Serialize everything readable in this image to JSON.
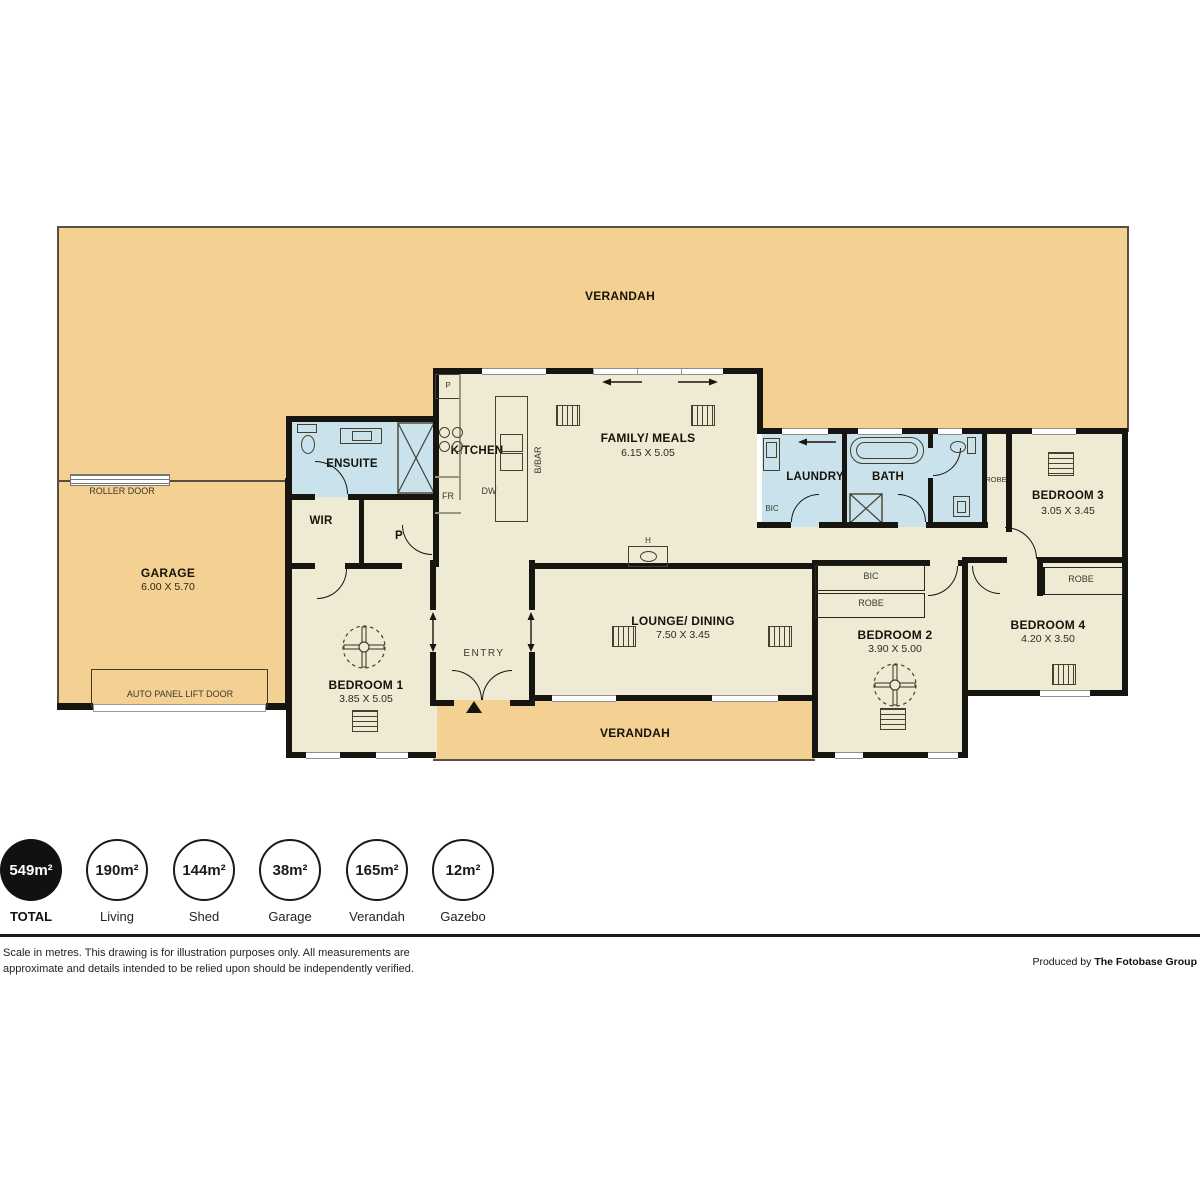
{
  "plan": {
    "verandah_top": "VERANDAH",
    "verandah_bottom": "VERANDAH",
    "garage": {
      "name": "GARAGE",
      "dims": "6.00 X 5.70"
    },
    "roller_door": "ROLLER DOOR",
    "auto_panel_lift_door": "AUTO PANEL LIFT DOOR",
    "ensuite": "ENSUITE",
    "wir": "WIR",
    "pantry": "P",
    "kitchen": {
      "name": "KITCHEN",
      "pantry": "P",
      "fridge": "FR",
      "dishwasher": "DW",
      "breakfast_bar": "B/BAR"
    },
    "family_meals": {
      "name": "FAMILY/ MEALS",
      "dims": "6.15 X 5.05"
    },
    "laundry": {
      "name": "LAUNDRY",
      "bic": "BIC"
    },
    "bath": "BATH",
    "robe_bed3": "ROBE",
    "bedroom3": {
      "name": "BEDROOM 3",
      "dims": "3.05 X 3.45"
    },
    "hot_water": "H",
    "bic_hall": "BIC",
    "robe_hall": "ROBE",
    "robe_bed4": "ROBE",
    "lounge_dining": {
      "name": "LOUNGE/ DINING",
      "dims": "7.50 X 3.45"
    },
    "entry": "ENTRY",
    "bedroom1": {
      "name": "BEDROOM 1",
      "dims": "3.85 X 5.05"
    },
    "bedroom2": {
      "name": "BEDROOM 2",
      "dims": "3.90 X 5.00"
    },
    "bedroom4": {
      "name": "BEDROOM 4",
      "dims": "4.20 X 3.50"
    }
  },
  "legend": {
    "items": [
      {
        "value": "549m²",
        "label": "TOTAL",
        "filled": true
      },
      {
        "value": "190m²",
        "label": "Living",
        "filled": false
      },
      {
        "value": "144m²",
        "label": "Shed",
        "filled": false
      },
      {
        "value": "38m²",
        "label": "Garage",
        "filled": false
      },
      {
        "value": "165m²",
        "label": "Verandah",
        "filled": false
      },
      {
        "value": "12m²",
        "label": "Gazebo",
        "filled": false
      }
    ]
  },
  "footer": {
    "disclaimer": "Scale in metres. This drawing is for illustration purposes only. All measurements are approximate and details intended to be relied upon should be independently verified.",
    "produced_by_prefix": "Produced by",
    "produced_by_name": "The Fotobase Group"
  },
  "colors": {
    "verandah": "#F4D092",
    "interior": "#EEEAD4",
    "wet_area": "#C9E2EB",
    "wall": "#17150f"
  }
}
